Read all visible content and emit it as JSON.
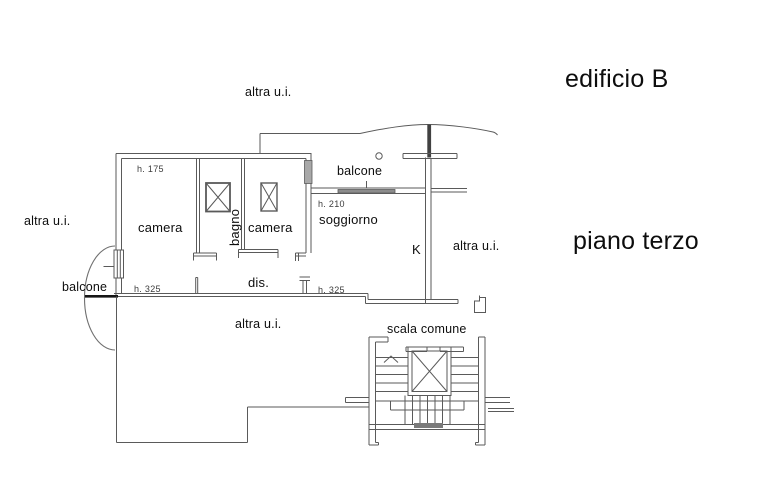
{
  "title": {
    "building": "edificio B",
    "floor": "piano terzo"
  },
  "rooms": {
    "camera_left": "camera",
    "camera_right": "camera",
    "bagno": "bagno",
    "soggiorno": "soggiorno",
    "dis": "dis.",
    "kitchen": "K"
  },
  "annotations": {
    "altra_ui_top": "altra u.i.",
    "altra_ui_left": "altra u.i.",
    "altra_ui_right": "altra u.i.",
    "altra_ui_bottom": "altra u.i.",
    "balcone_top": "balcone",
    "balcone_left": "balcone",
    "scala_comune": "scala comune",
    "h_camera": "h. 175",
    "h_soggiorno": "h. 210",
    "h_dis_left": "h. 325",
    "h_dis_right": "h. 325"
  },
  "colors": {
    "background": "#ffffff",
    "line": "#5a5a5a",
    "thick_line": "#161616",
    "text": "#0d0d0d",
    "muted_text": "#3c3c3c",
    "window_fill": "#8c8c8c"
  }
}
